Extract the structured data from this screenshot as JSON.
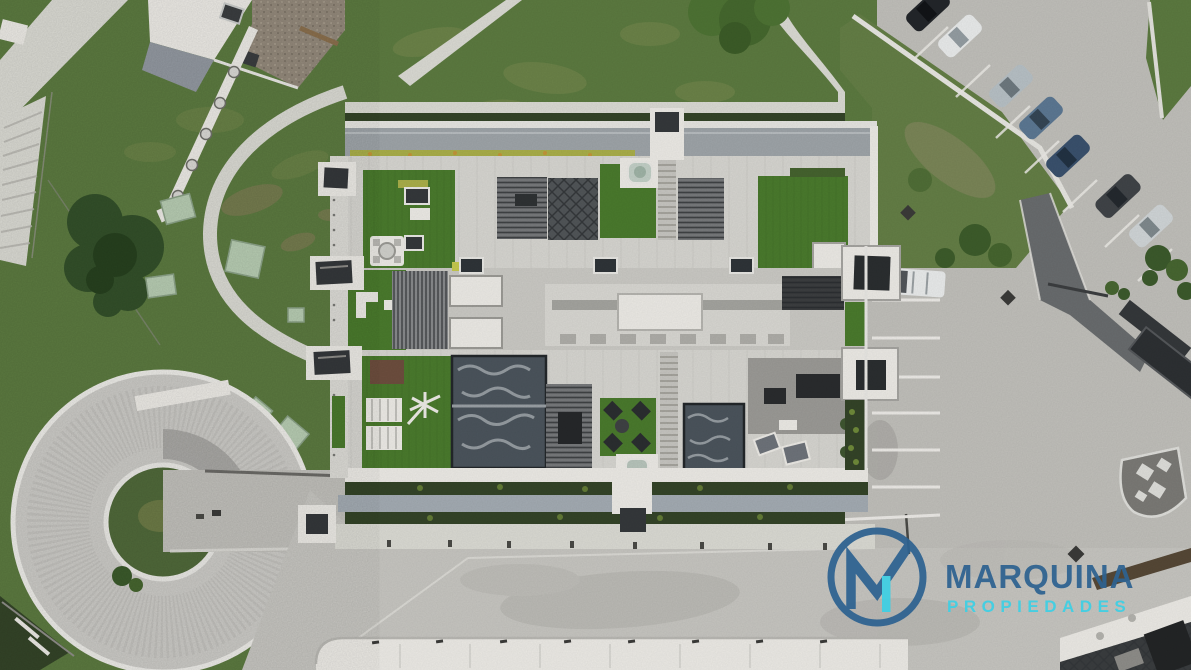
{
  "meta": {
    "description": "Aerial drone photograph of a modern residential building with rooftop terraces, artificial-turf patios, pergolas, a jacuzzi, a circular garage ramp, gardens, footpaths and a parking lot",
    "width_px": 1191,
    "height_px": 670
  },
  "watermark": {
    "brand": "MARQUINA",
    "tagline": "PROPIEDADES",
    "monogram": "M",
    "brand_color": "#2e6290",
    "tagline_color": "#3ecfe3"
  },
  "objects": {
    "parked_cars_in_row": 7,
    "car_colors": [
      "black",
      "white",
      "silver",
      "steel-blue",
      "dark-blue",
      "charcoal",
      "silver-white"
    ],
    "rooftop_features": [
      "artificial-turf terraces",
      "louvered pergolas",
      "jacuzzi",
      "wavy glass skylights",
      "sun loungers",
      "lounge chairs",
      "stair cores"
    ],
    "site_features": [
      "circular garage ramp",
      "winding garden paths",
      "parking stalls",
      "entrance gate",
      "hedges",
      "trees"
    ]
  },
  "palette": {
    "grass": "#5c7a40",
    "grass_dark": "#50693a",
    "scrub": "#647e46",
    "turf": "#4a7a2d",
    "tree": "#33502a",
    "hedge": "#344428",
    "concrete": "#c0bfba",
    "plaza": "#c6c5c0",
    "path": "#dadad3",
    "white_structure": "#eceae5",
    "terrace": "#d6d5d0",
    "terrace_light": "#dcdbd6",
    "roof_metal": "#9ea4a8",
    "facade": "#a3abb2",
    "gravel": "#93897b",
    "asphalt": "#696c6e",
    "dark_structure": "#35383b",
    "glass_dark": "#4b545c",
    "pergola": "#77797b",
    "pergola_dark": "#515558",
    "deck_gray": "#9b9a96",
    "skylight_panel": "#b7ccb2",
    "flower": "#a9ae49",
    "wood_brown": "#6d4e3e",
    "car_black": "#23262a",
    "car_white": "#e9ebeb",
    "car_silver": "#b7c0c5",
    "car_steel_blue": "#5c7893",
    "car_dark_blue": "#3a516d",
    "car_charcoal": "#404448",
    "car_silver_white": "#d0d5d7",
    "brand_blue": "#2e6290",
    "brand_cyan": "#3ecfe3"
  }
}
